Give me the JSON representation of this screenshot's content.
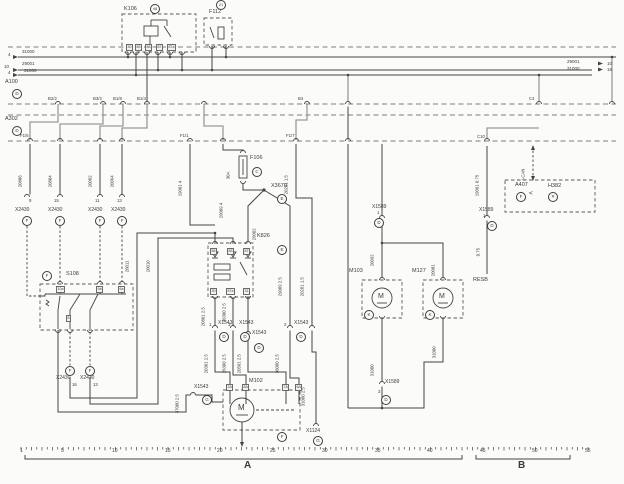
{
  "meta": {
    "ink": "#454545",
    "gray_wire": "#9a9a98",
    "bg": "#fbfbf9",
    "diagram_type": "automotive wiring schematic"
  },
  "sections": {
    "a_label": "A",
    "b_label": "B"
  },
  "ruler_numbers": [
    {
      "n": "ruler-1",
      "t": "1",
      "x": 20
    },
    {
      "n": "ruler-5",
      "t": "5",
      "x": 61
    },
    {
      "n": "ruler-10",
      "t": "10",
      "x": 112
    },
    {
      "n": "ruler-15",
      "t": "15",
      "x": 165
    },
    {
      "n": "ruler-20",
      "t": "20",
      "x": 217
    },
    {
      "n": "ruler-25",
      "t": "25",
      "x": 270
    },
    {
      "n": "ruler-30",
      "t": "30",
      "x": 322
    },
    {
      "n": "ruler-35",
      "t": "35",
      "x": 375
    },
    {
      "n": "ruler-40",
      "t": "40",
      "x": 427
    },
    {
      "n": "ruler-45",
      "t": "45",
      "x": 480
    },
    {
      "n": "ruler-50",
      "t": "50",
      "x": 532
    },
    {
      "n": "ruler-55",
      "t": "55",
      "x": 585
    }
  ],
  "labels": [
    {
      "n": "relay-k106-label",
      "t": "K106",
      "x": 124,
      "y": 7,
      "s": 5.5
    },
    {
      "n": "fuse-f112-label",
      "t": "F112",
      "x": 209,
      "y": 10,
      "s": 5.5
    },
    {
      "n": "module-a100-label",
      "t": "A100",
      "x": 5,
      "y": 80,
      "s": 5.5
    },
    {
      "n": "module-a302-label",
      "t": "A302",
      "x": 5,
      "y": 117,
      "s": 5.5
    },
    {
      "n": "switch-s108-label",
      "t": "S108",
      "x": 66,
      "y": 272,
      "s": 5.5
    },
    {
      "n": "relay-k826-label",
      "t": "K826",
      "x": 257,
      "y": 234,
      "s": 5.5
    },
    {
      "n": "fuse-f106-label",
      "t": "F106",
      "x": 250,
      "y": 156,
      "s": 5.5
    },
    {
      "n": "splice-x3670-label",
      "t": "X3670",
      "x": 271,
      "y": 184,
      "s": 5.5
    },
    {
      "n": "motor-m102-label",
      "t": "M102",
      "x": 249,
      "y": 379,
      "s": 5.5
    },
    {
      "n": "motor-m103-label",
      "t": "M103",
      "x": 349,
      "y": 269,
      "s": 5.5
    },
    {
      "n": "motor-m127-label",
      "t": "M127",
      "x": 412,
      "y": 269,
      "s": 5.5
    },
    {
      "n": "resb-label",
      "t": "RESB",
      "x": 473,
      "y": 278,
      "s": 5.5
    },
    {
      "n": "module-a407-label",
      "t": "A407",
      "x": 515,
      "y": 183,
      "s": 5.5
    },
    {
      "n": "lamp-h382-label",
      "t": "H382",
      "x": 548,
      "y": 184,
      "s": 5.5
    },
    {
      "n": "connector-x1124-label",
      "t": "X1124",
      "x": 306,
      "y": 429,
      "s": 5
    },
    {
      "n": "connector-x2430-label-1",
      "t": "X2430",
      "x": 15,
      "y": 208,
      "s": 5
    },
    {
      "n": "connector-x2430-label-2",
      "t": "X2430",
      "x": 48,
      "y": 208,
      "s": 5
    },
    {
      "n": "connector-x2430-label-3",
      "t": "X2430",
      "x": 88,
      "y": 208,
      "s": 5
    },
    {
      "n": "connector-x2430-label-4",
      "t": "X2430",
      "x": 111,
      "y": 208,
      "s": 5
    },
    {
      "n": "connector-x2430-label-5",
      "t": "X2430",
      "x": 56,
      "y": 376,
      "s": 5
    },
    {
      "n": "connector-x2430-label-6",
      "t": "X2430",
      "x": 80,
      "y": 376,
      "s": 5
    },
    {
      "n": "connector-x1543-label-1",
      "t": "X1543",
      "x": 218,
      "y": 321,
      "s": 5
    },
    {
      "n": "connector-x1543-label-2",
      "t": "X1543",
      "x": 239,
      "y": 321,
      "s": 5
    },
    {
      "n": "connector-x1543-label-3",
      "t": "X1543",
      "x": 294,
      "y": 321,
      "s": 5
    },
    {
      "n": "connector-x1543-label-4",
      "t": "X1543",
      "x": 252,
      "y": 331,
      "s": 5
    },
    {
      "n": "connector-x1543-label-5",
      "t": "X1543",
      "x": 194,
      "y": 385,
      "s": 5
    },
    {
      "n": "connector-x1589-label-1",
      "t": "X1589",
      "x": 372,
      "y": 205,
      "s": 5
    },
    {
      "n": "connector-x1589-label-2",
      "t": "X1589",
      "x": 385,
      "y": 380,
      "s": 5
    },
    {
      "n": "connector-x1589-label-3",
      "t": "X1589",
      "x": 479,
      "y": 208,
      "s": 5
    },
    {
      "n": "bus-wire-31000-left",
      "t": "31000",
      "x": 22,
      "y": 50,
      "s": 4.5
    },
    {
      "n": "bus-track-4a",
      "t": "4",
      "x": 8,
      "y": 52.5,
      "s": 4.5
    },
    {
      "n": "bus-wire-29001-left",
      "t": "29001",
      "x": 22,
      "y": 62,
      "s": 4.5
    },
    {
      "n": "bus-track-10a",
      "t": "10",
      "x": 4,
      "y": 64.5,
      "s": 4.5
    },
    {
      "n": "bus-wire-31000-left2",
      "t": "31000",
      "x": 24,
      "y": 68.5,
      "s": 4.5
    },
    {
      "n": "bus-track-4b",
      "t": "4",
      "x": 8,
      "y": 71,
      "s": 4.5
    },
    {
      "n": "bus-wire-29001-right",
      "t": "29001",
      "x": 567,
      "y": 60,
      "s": 4.5
    },
    {
      "n": "bus-track-10b",
      "t": "10",
      "x": 607,
      "y": 61.5,
      "s": 4.5
    },
    {
      "n": "bus-wire-31000-right",
      "t": "31000",
      "x": 567,
      "y": 66.5,
      "s": 4.5
    },
    {
      "n": "bus-track-15",
      "t": "15",
      "x": 607,
      "y": 68,
      "s": 4.5
    },
    {
      "n": "pin-b2-2",
      "t": "B2/2",
      "x": 48,
      "y": 97,
      "s": 4.3
    },
    {
      "n": "pin-b3-2",
      "t": "B3/2",
      "x": 93,
      "y": 97,
      "s": 4.3
    },
    {
      "n": "pin-b1-8",
      "t": "B1/8",
      "x": 113,
      "y": 97,
      "s": 4.3
    },
    {
      "n": "pin-b1-4",
      "t": "B1/4",
      "x": 137,
      "y": 97,
      "s": 4.3
    },
    {
      "n": "pin-b4",
      "t": "B4",
      "x": 298,
      "y": 97,
      "s": 4.3
    },
    {
      "n": "pin-c4",
      "t": "C4",
      "x": 529,
      "y": 97,
      "s": 4.3
    },
    {
      "n": "pin-f1-5",
      "t": "F1/5",
      "x": 20,
      "y": 134,
      "s": 4.3
    },
    {
      "n": "pin-f1-1",
      "t": "F1/1",
      "x": 180,
      "y": 134,
      "s": 4.3
    },
    {
      "n": "pin-f1-7",
      "t": "F1/7",
      "x": 286,
      "y": 134,
      "s": 4.3
    },
    {
      "n": "pin-c10",
      "t": "C10",
      "x": 477,
      "y": 135,
      "s": 4.3
    },
    {
      "n": "pin-num-9",
      "t": "9",
      "x": 29,
      "y": 199,
      "s": 4.3
    },
    {
      "n": "pin-num-15",
      "t": "15",
      "x": 54,
      "y": 199,
      "s": 4.3
    },
    {
      "n": "pin-num-11",
      "t": "11",
      "x": 95,
      "y": 199,
      "s": 4.3
    },
    {
      "n": "pin-num-13",
      "t": "13",
      "x": 117,
      "y": 199,
      "s": 4.3
    },
    {
      "n": "pin-num-16",
      "t": "16",
      "x": 72,
      "y": 383,
      "s": 4.3
    },
    {
      "n": "pin-num-13b",
      "t": "13",
      "x": 93,
      "y": 383,
      "s": 4.3
    },
    {
      "n": "pin-num-1a",
      "t": "1",
      "x": 377,
      "y": 211,
      "s": 4.3
    },
    {
      "n": "pin-num-3a",
      "t": "3",
      "x": 378,
      "y": 390,
      "s": 4.3
    },
    {
      "n": "pin-num-1b",
      "t": "1",
      "x": 483,
      "y": 214,
      "s": 4.3
    },
    {
      "n": "pin-num-x1543-1",
      "t": "1",
      "x": 209,
      "y": 323,
      "s": 4.3
    },
    {
      "n": "pin-num-x1543-3",
      "t": "3",
      "x": 228,
      "y": 323,
      "s": 4.3
    },
    {
      "n": "pin-num-x1543-2",
      "t": "2",
      "x": 284,
      "y": 323,
      "s": 4.3
    },
    {
      "n": "pin-num-x1543-5",
      "t": "5",
      "x": 244,
      "y": 336,
      "s": 4.3
    },
    {
      "n": "wire-label-20886",
      "t": "20886",
      "x": 23,
      "y": 183,
      "s": 4.3,
      "rot": true
    },
    {
      "n": "wire-label-20884",
      "t": "20884",
      "x": 53,
      "y": 183,
      "s": 4.3,
      "rot": true
    },
    {
      "n": "wire-label-20082",
      "t": "20082",
      "x": 93,
      "y": 183,
      "s": 4.3,
      "rot": true
    },
    {
      "n": "wire-label-20094",
      "t": "20094",
      "x": 115,
      "y": 183,
      "s": 4.3,
      "rot": true
    },
    {
      "n": "wire-label-20011",
      "t": "20011",
      "x": 130,
      "y": 268,
      "s": 4.3,
      "rot": true
    },
    {
      "n": "wire-label-20010",
      "t": "20010",
      "x": 151,
      "y": 268,
      "s": 4.3,
      "rot": true
    },
    {
      "n": "wire-label-19001",
      "t": "19001  4",
      "x": 183,
      "y": 192,
      "s": 4.3,
      "rot": true
    },
    {
      "n": "wire-label-30a",
      "t": "30A",
      "x": 231,
      "y": 175,
      "s": 4.3,
      "rot": true
    },
    {
      "n": "wire-label-29009",
      "t": "29009  4",
      "x": 224,
      "y": 214,
      "s": 4.3,
      "rot": true
    },
    {
      "n": "wire-label-29002",
      "t": "29002",
      "x": 257,
      "y": 236,
      "s": 4.3,
      "rot": true
    },
    {
      "n": "wire-label-20201a",
      "t": "20201  1.5",
      "x": 289,
      "y": 190,
      "s": 4.3,
      "rot": true
    },
    {
      "n": "wire-label-29009b",
      "t": "29009  2.5",
      "x": 283,
      "y": 292,
      "s": 4.3,
      "rot": true
    },
    {
      "n": "wire-label-20201b",
      "t": "20201  1.5",
      "x": 305,
      "y": 292,
      "s": 4.3,
      "rot": true
    },
    {
      "n": "wire-label-20801",
      "t": "20801  2.5",
      "x": 206,
      "y": 322,
      "s": 4.3,
      "rot": true
    },
    {
      "n": "wire-label-36300",
      "t": "36300  2.5",
      "x": 227,
      "y": 318,
      "s": 4.3,
      "rot": true
    },
    {
      "n": "wire-label-20301",
      "t": "20301  2.5",
      "x": 209,
      "y": 369,
      "s": 4.3,
      "rot": true
    },
    {
      "n": "wire-label-26300",
      "t": "26300  2.5",
      "x": 227,
      "y": 369,
      "s": 4.3,
      "rot": true
    },
    {
      "n": "wire-label-20501",
      "t": "20501  2.5",
      "x": 242,
      "y": 369,
      "s": 4.3,
      "rot": true
    },
    {
      "n": "wire-label-36000",
      "t": "36000  2.5",
      "x": 280,
      "y": 369,
      "s": 4.3,
      "rot": true
    },
    {
      "n": "wire-label-31000a",
      "t": "31000  2.5",
      "x": 306,
      "y": 402,
      "s": 4.3,
      "rot": true
    },
    {
      "n": "wire-label-37000",
      "t": "37000  2.5",
      "x": 180,
      "y": 409,
      "s": 4.3,
      "rot": true
    },
    {
      "n": "wire-label-20092",
      "t": "20092",
      "x": 375,
      "y": 262,
      "s": 4.3,
      "rot": true
    },
    {
      "n": "wire-label-20081",
      "t": "20081",
      "x": 436,
      "y": 272,
      "s": 4.3,
      "rot": true
    },
    {
      "n": "wire-label-31000b",
      "t": "31000",
      "x": 375,
      "y": 372,
      "s": 4.3,
      "rot": true
    },
    {
      "n": "wire-label-31000c",
      "t": "31000",
      "x": 437,
      "y": 354,
      "s": 4.3,
      "rot": true
    },
    {
      "n": "wire-label-19061",
      "t": "19061  0.75",
      "x": 480,
      "y": 192,
      "s": 4.3,
      "rot": true
    },
    {
      "n": "wire-label-075",
      "t": "0.75",
      "x": 481,
      "y": 252,
      "s": 4.3,
      "rot": true
    },
    {
      "n": "wire-label-ican",
      "t": "I-CAN",
      "x": 526,
      "y": 176,
      "s": 4.3,
      "rot": true
    },
    {
      "n": "motor-m102-letter",
      "t": "M",
      "x": 238,
      "y": 404,
      "s": 8
    },
    {
      "n": "motor-m103-letter",
      "t": "M",
      "x": 378,
      "y": 293,
      "s": 7
    },
    {
      "n": "motor-m127-letter",
      "t": "M",
      "x": 439,
      "y": 293,
      "s": 7
    },
    {
      "n": "a407-plug-arrow",
      "t": "<",
      "x": 529,
      "y": 191,
      "s": 6.5
    },
    {
      "n": "section-a-label",
      "t": "A",
      "x": 244,
      "y": 461,
      "s": 10,
      "b": true
    },
    {
      "n": "section-b-label",
      "t": "B",
      "x": 518,
      "y": 461,
      "s": 10,
      "b": true
    }
  ],
  "circled_refs": [
    {
      "n": "k106-track-ref",
      "t": "48",
      "x": 150,
      "y": 4
    },
    {
      "n": "f112-track-ref",
      "t": "21",
      "x": 216,
      "y": 0
    },
    {
      "n": "a100-page-ref",
      "t": "D",
      "x": 12,
      "y": 89
    },
    {
      "n": "a302-page-ref",
      "t": "D",
      "x": 12,
      "y": 126
    },
    {
      "n": "x2430-ref-1",
      "t": "F",
      "x": 22,
      "y": 216
    },
    {
      "n": "x2430-ref-2",
      "t": "F",
      "x": 55,
      "y": 216
    },
    {
      "n": "x2430-ref-3",
      "t": "F",
      "x": 95,
      "y": 216
    },
    {
      "n": "x2430-ref-4",
      "t": "F",
      "x": 117,
      "y": 216
    },
    {
      "n": "s108-ref",
      "t": "F",
      "x": 42,
      "y": 271
    },
    {
      "n": "x2430-ref-5",
      "t": "F",
      "x": 65,
      "y": 366
    },
    {
      "n": "x2430-ref-6",
      "t": "F",
      "x": 85,
      "y": 366
    },
    {
      "n": "x1543-ref-1",
      "t": "D",
      "x": 219,
      "y": 332
    },
    {
      "n": "x1543-ref-2",
      "t": "D",
      "x": 240,
      "y": 332
    },
    {
      "n": "x1543-ref-3",
      "t": "D",
      "x": 296,
      "y": 332
    },
    {
      "n": "x1543-ref-4",
      "t": "D",
      "x": 254,
      "y": 343
    },
    {
      "n": "x1543-ref-5",
      "t": "G",
      "x": 202,
      "y": 395
    },
    {
      "n": "f106-ref",
      "t": "C",
      "x": 252,
      "y": 167
    },
    {
      "n": "x3670-ref",
      "t": "E",
      "x": 277,
      "y": 194
    },
    {
      "n": "k826-ref",
      "t": "E",
      "x": 277,
      "y": 245
    },
    {
      "n": "m102-ref",
      "t": "F",
      "x": 277,
      "y": 432
    },
    {
      "n": "x1589-ref-1",
      "t": "D",
      "x": 374,
      "y": 218
    },
    {
      "n": "x1589-ref-2",
      "t": "D",
      "x": 381,
      "y": 395
    },
    {
      "n": "x1589-ref-3",
      "t": "D",
      "x": 487,
      "y": 221
    },
    {
      "n": "m103-ref",
      "t": "K",
      "x": 364,
      "y": 310
    },
    {
      "n": "m127-ref",
      "t": "K",
      "x": 425,
      "y": 310
    },
    {
      "n": "x1124-ref",
      "t": "G",
      "x": 313,
      "y": 436
    },
    {
      "n": "a407-ref",
      "t": "F",
      "x": 516,
      "y": 192
    },
    {
      "n": "h382-lamp-symbol",
      "t": "✕",
      "x": 548,
      "y": 192
    }
  ],
  "boxed_pins": [
    {
      "n": "k106-pin-30",
      "t": "30",
      "x": 126,
      "y": 44
    },
    {
      "n": "k106-pin-85",
      "t": "85",
      "x": 135,
      "y": 44
    },
    {
      "n": "k106-pin-86",
      "t": "86",
      "x": 145,
      "y": 44
    },
    {
      "n": "k106-pin-87",
      "t": "87",
      "x": 156,
      "y": 44
    },
    {
      "n": "k106-pin-87a",
      "t": "87a",
      "x": 167,
      "y": 44
    },
    {
      "n": "k826-pin-86",
      "t": "86",
      "x": 210,
      "y": 248
    },
    {
      "n": "k826-pin-85",
      "t": "85",
      "x": 227,
      "y": 248
    },
    {
      "n": "k826-pin-87",
      "t": "87",
      "x": 243,
      "y": 248
    },
    {
      "n": "k826-pin-30",
      "t": "30",
      "x": 210,
      "y": 288
    },
    {
      "n": "k826-pin-87a",
      "t": "87a",
      "x": 226,
      "y": 288
    },
    {
      "n": "k826-pin-31",
      "t": "31",
      "x": 243,
      "y": 288
    },
    {
      "n": "m102-pin-3a",
      "t": "3A",
      "x": 226,
      "y": 384
    },
    {
      "n": "m102-pin-8a",
      "t": "8A",
      "x": 242,
      "y": 384
    },
    {
      "n": "m102-pin-7a",
      "t": "7A",
      "x": 282,
      "y": 384
    },
    {
      "n": "m102-pin-6a",
      "t": "6A",
      "x": 295,
      "y": 384
    },
    {
      "n": "s108-pin-10a",
      "t": "10a",
      "x": 56,
      "y": 286
    },
    {
      "n": "s108-pin-9a",
      "t": "9a",
      "x": 96,
      "y": 286
    },
    {
      "n": "s108-pin-6a",
      "t": "6a",
      "x": 118,
      "y": 286
    },
    {
      "n": "s108-pin-8",
      "t": "8",
      "x": 66,
      "y": 315
    }
  ]
}
